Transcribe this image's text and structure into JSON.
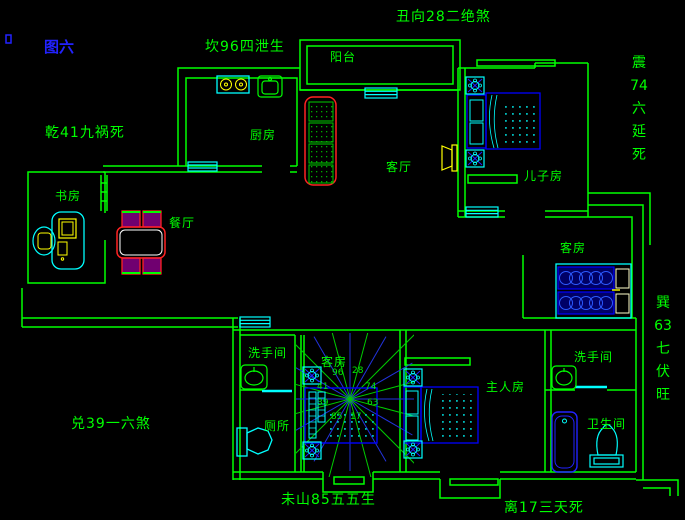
{
  "figure": {
    "title": "图六"
  },
  "perimeter_labels": {
    "north": "坎96四泄生",
    "gate": "丑向28二绝煞",
    "northwest": "乾41九祸死",
    "east_lines": [
      "震",
      "74",
      "六",
      "延",
      "死"
    ],
    "southeast_lines": [
      "巽",
      "63",
      "七",
      "伏",
      "旺"
    ],
    "west": "兑39一六煞",
    "south_center": "未山85五五生",
    "south_right": "离17三天死"
  },
  "rooms": {
    "balcony": "阳台",
    "kitchen": "厨房",
    "living": "客厅",
    "sons_room": "儿子房",
    "study": "书房",
    "dining": "餐厅",
    "guest_east": "客房",
    "guest_center": "客房",
    "washroom_left": "洗手间",
    "washroom_right": "洗手间",
    "toilet": "厕所",
    "master": "主人房",
    "bathroom": "卫生间"
  },
  "compass_numbers": [
    "96",
    "28",
    "74",
    "63",
    "17",
    "85",
    "39",
    "41"
  ],
  "colors": {
    "background": "#000000",
    "wall": "#00ff00",
    "fixture": "#00ffff",
    "furniture": "#0000ff",
    "accent": "#ff0000",
    "highlight": "#ffff00",
    "label": "#00ff00",
    "figure_title": "#2222ff"
  }
}
